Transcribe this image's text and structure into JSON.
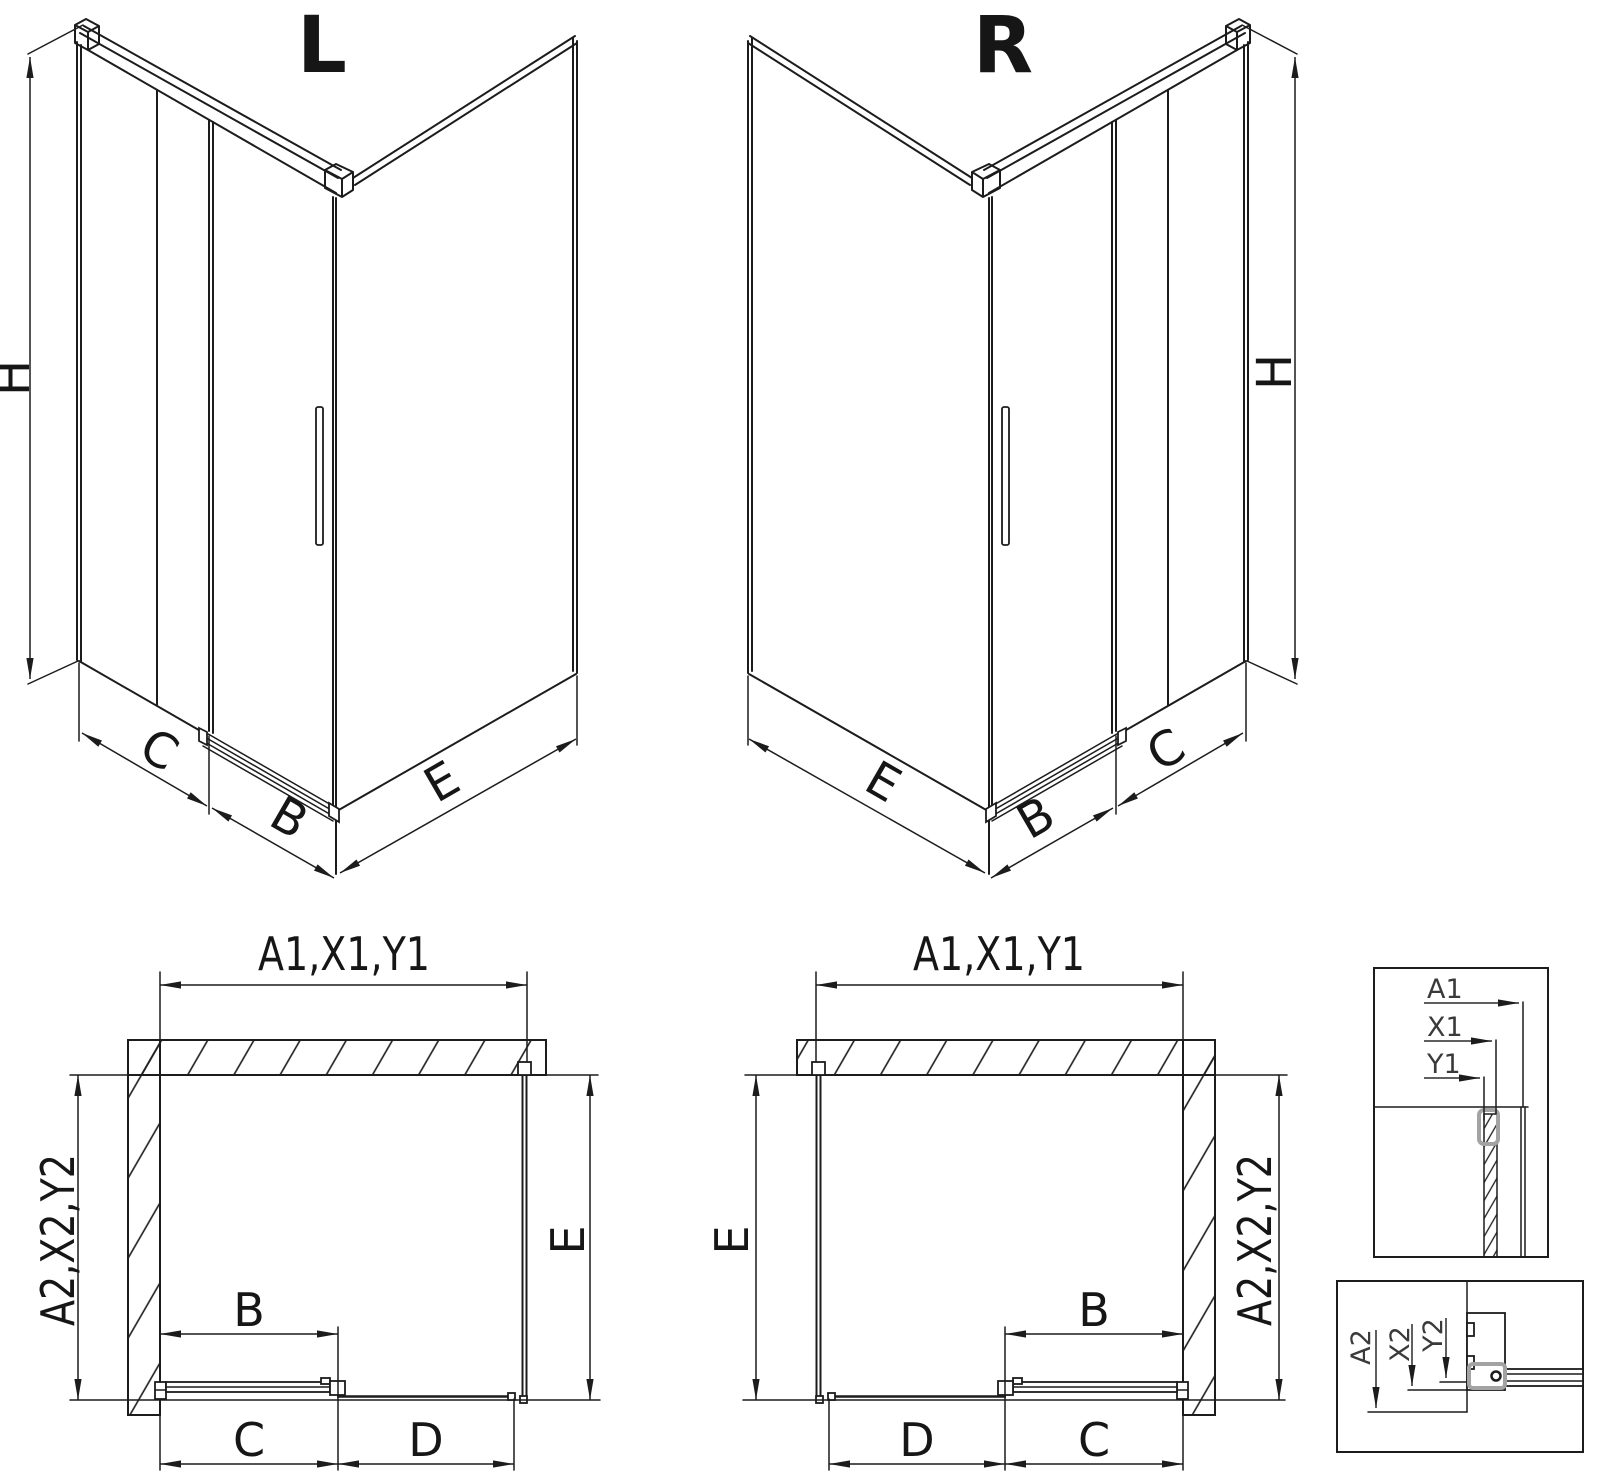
{
  "page": {
    "background": "#ffffff",
    "line_color": "#1c1c1c",
    "gray_accent": "#a3a3a3",
    "description": "Shower enclosure technical drawing with left (L) and right (R) corner-entry variants, plan views and wall-profile detail sections"
  },
  "iso_left": {
    "title": "L",
    "dim_height": "H",
    "dim_side_panel": "C",
    "dim_door": "B",
    "dim_return_panel": "E"
  },
  "iso_right": {
    "title": "R",
    "dim_height": "H",
    "dim_side_panel": "C",
    "dim_door": "B",
    "dim_return_panel": "E"
  },
  "plan_left": {
    "dim_width_top": "A1,X1,Y1",
    "dim_depth_left": "A2,X2,Y2",
    "dim_depth_inner": "E",
    "dim_door": "B",
    "dim_bottom_left": "C",
    "dim_bottom_right": "D"
  },
  "plan_right": {
    "dim_width_top": "A1,X1,Y1",
    "dim_depth_right": "A2,X2,Y2",
    "dim_depth_inner": "E",
    "dim_door": "B",
    "dim_bottom_right": "C",
    "dim_bottom_left": "D"
  },
  "detail_top": {
    "labels": [
      "A1",
      "X1",
      "Y1"
    ]
  },
  "detail_bottom": {
    "labels": [
      "A2",
      "X2",
      "Y2"
    ]
  }
}
